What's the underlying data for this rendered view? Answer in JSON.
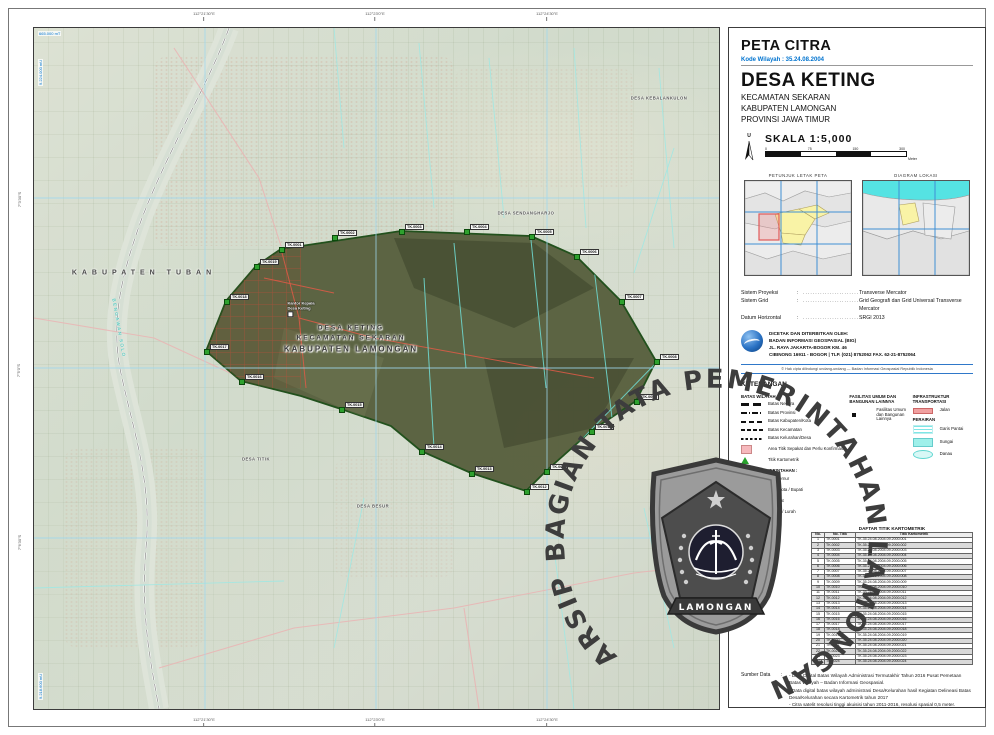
{
  "header": {
    "title": "PETA CITRA",
    "kode": "Kode Wilayah : 35.24.08.2004",
    "village": "DESA KETING",
    "admin_lines": [
      "KECAMATAN SEKARAN",
      "KABUPATEN LAMONGAN",
      "PROVINSI JAWA TIMUR"
    ],
    "north_label": "U",
    "skala_label": "SKALA  1:5,000",
    "scalebar_ticks": [
      "0",
      "75",
      "150",
      "300"
    ],
    "scalebar_unit": "Meter"
  },
  "insets": {
    "left_caption": "PETUNJUK LETAK PETA",
    "right_caption": "DIAGRAM LOKASI"
  },
  "projection": {
    "rows": [
      {
        "label": "Sistem Proyeksi",
        "value": "Transverse Mercator"
      },
      {
        "label": "Sistem Grid",
        "value": "Grid Geografi dan Grid Universal Transverse Mercator"
      },
      {
        "label": "Datum Horizontal",
        "value": "SRGI 2013"
      }
    ]
  },
  "publisher": {
    "lines": [
      "DICETAK DAN DITERBITKAN OLEH:",
      "BADAN INFORMASI GEOSPASIAL (BIG)",
      "JL. RAYA JAKARTA-BOGOR KM. 46",
      "CIBINONG 16911 - BOGOR | TLP. (021) 8752062 FAX. 62-21-8752064"
    ],
    "copyright": "© Hak cipta dilindungi undang-undang — Badan Informasi Geospasial Republik Indonesia"
  },
  "legend": {
    "title": "KETERANGAN",
    "batas_title": "BATAS WILAYAH :",
    "batas_items": [
      {
        "label": "Batas Negara",
        "style": "sw-negara"
      },
      {
        "label": "Batas Provinsi",
        "style": "sw-provinsi"
      },
      {
        "label": "Batas Kabupaten/Kota",
        "style": "sw-kabkota"
      },
      {
        "label": "Batas Kecamatan",
        "style": "sw-kecamatan"
      },
      {
        "label": "Batas Kelurahan/Desa",
        "style": "sw-desa"
      },
      {
        "label": "Area Titik Sepakat dan Perlu Konfirmasi",
        "style": "sw-area"
      },
      {
        "label": "Titik Kartometrik",
        "style": "sw-titik"
      }
    ],
    "fasum_title": "FASILITAS UMUM DAN BANGUNAN LAINNYA",
    "fasum_items": [
      {
        "label": "Fasilitas Umum dan Bangunan Lainnya",
        "style": "sw-fasum"
      }
    ],
    "infra_title": "INFRASTRUKTUR TRANSPORTASI",
    "infra_items": [
      {
        "label": "Jalan",
        "style": "sw-jalan"
      }
    ],
    "perairan_title": "PERAIRAN",
    "perairan_items": [
      {
        "label": "Garis Pantai",
        "style": "sw-pantai"
      },
      {
        "label": "Sungai",
        "style": "sw-sungai"
      },
      {
        "label": "Danau",
        "style": "sw-danau"
      }
    ],
    "kantor_title": "KANTOR PEMERINTAHAN :",
    "kantor_items": [
      {
        "label": "Gubernur",
        "cls": "one"
      },
      {
        "label": "Walikota / Bupati",
        "cls": "two"
      },
      {
        "label": "Camat",
        "cls": "one"
      },
      {
        "label": "Desa / Lurah",
        "cls": "two"
      }
    ]
  },
  "table": {
    "title": "DAFTAR TITIK KARTOMETRIK",
    "headers": [
      "No.",
      "No. Titik",
      "Titik Kartometrik"
    ],
    "rows": [
      [
        "1",
        "TK.0001",
        "TK.35.24.08.2004.09.2000.001"
      ],
      [
        "2",
        "TK.0002",
        "TK.35.24.08.2004.09.2000.002"
      ],
      [
        "3",
        "TK.0003",
        "TK.35.24.08.2004.09.2000.003"
      ],
      [
        "4",
        "TK.0004",
        "TK.35.24.08.2004.09.2000.004"
      ],
      [
        "5",
        "TK.0005",
        "TK.35.24.08.2004.09.2000.005"
      ],
      [
        "6",
        "TK.0006",
        "TK.35.24.08.2004.09.2000.006"
      ],
      [
        "7",
        "TK.0007",
        "TK.35.24.08.2004.09.2000.007"
      ],
      [
        "8",
        "TK.0008",
        "TK.35.24.08.2004.09.2000.008"
      ],
      [
        "9",
        "TK.0009",
        "TK.35.24.08.2004.09.2000.009"
      ],
      [
        "10",
        "TK.0010",
        "TK.35.24.08.2004.09.2000.010"
      ],
      [
        "11",
        "TK.0011",
        "TK.35.24.08.2004.09.2000.011"
      ],
      [
        "12",
        "TK.0012",
        "TK.35.24.08.2004.09.2000.012"
      ],
      [
        "13",
        "TK.0013",
        "TK.35.24.08.2004.09.2000.013"
      ],
      [
        "14",
        "TK.0014",
        "TK.35.24.08.2004.09.2000.014"
      ],
      [
        "15",
        "TK.0015",
        "TK.35.24.08.2004.09.2000.015"
      ],
      [
        "16",
        "TK.0016",
        "TK.35.24.08.2004.09.2000.016"
      ],
      [
        "17",
        "TK.0017",
        "TK.35.24.08.2004.09.2000.017"
      ],
      [
        "18",
        "TK.0018",
        "TK.35.24.08.2004.09.2000.018"
      ],
      [
        "19",
        "TK.0019",
        "TK.35.24.08.2004.09.2000.019"
      ],
      [
        "20",
        "TK.0020",
        "TK.35.24.08.2004.09.2000.020"
      ],
      [
        "21",
        "TK.0021",
        "TK.35.24.08.2004.09.2000.021"
      ],
      [
        "22",
        "TK.0022",
        "TK.35.24.08.2004.09.2000.022"
      ],
      [
        "23",
        "TK.0023",
        "TK.35.24.08.2004.09.2000.023"
      ],
      [
        "24",
        "TK.0024",
        "TK.35.24.08.2004.09.2000.024"
      ]
    ]
  },
  "sources": {
    "label": "Sumber Data",
    "colon": ":",
    "items": [
      "- Data Digital Batas Wilayah Administrasi Termutakhir Tahun 2016 Pusat Pemetaan Batas Wilayah – Badan Informasi Geospasial.",
      "- Data digital batas wilayah administrasi Desa/Kelurahan hasil Kegiatan Delineasi Batas Desa/Kelurahan secara Kartometrik tahun 2017",
      "- Citra satelit resolusi tinggi akuisisi tahun 2011-2016, resolusi spasial 0,5 meter.",
      "- Data digital Peta Rupabumi Indonesia skala 1 : 25.000 Pusat Pemetaan Rupabumi dan Toponim - Badan Informasi Geospasial, edisi launching tahun 2016",
      "- Hasil Digitasi Unsur Transportasi dan Hidrografi Tahun 2017"
    ],
    "riwayat_label": "Riwayat Peta",
    "riwayat_items": [
      "- Peta Citra ini dibuat menggunakan data batas wilayah administrasi desa / kelurahan hasil delineasi secara kartometrik tahun 2017, yang ditampilkan di atas citra satelit resolusi tinggi dengan resolusi spasial 0,5 m hasil akuisisi tahun 2011-2016."
    ]
  },
  "map": {
    "region_label": "KABUPATEN TUBAN",
    "village_label_lines": [
      "DESA KETING",
      "KECAMATAN SEKARAN",
      "KABUPATEN LAMONGAN"
    ],
    "office_label_lines": [
      "Kantor Kepala",
      "Desa Keting"
    ],
    "river_label": "BENGAWAN SOLO",
    "area_labels": [
      {
        "text": "DESA SENDANGHARJO",
        "x": 492,
        "y": 185
      },
      {
        "text": "DESA KEBALANKULON",
        "x": 625,
        "y": 70
      },
      {
        "text": "DESA TITIK",
        "x": 222,
        "y": 431
      },
      {
        "text": "DESA BESUR",
        "x": 339,
        "y": 478
      }
    ],
    "markers": [
      {
        "id": "TK.0001",
        "x": 247,
        "y": 221
      },
      {
        "id": "TK.0002",
        "x": 300,
        "y": 209
      },
      {
        "id": "TK.0003",
        "x": 367,
        "y": 203
      },
      {
        "id": "TK.0004",
        "x": 432,
        "y": 203
      },
      {
        "id": "TK.0005",
        "x": 497,
        "y": 208
      },
      {
        "id": "TK.0006",
        "x": 542,
        "y": 228
      },
      {
        "id": "TK.0007",
        "x": 587,
        "y": 273
      },
      {
        "id": "TK.0008",
        "x": 622,
        "y": 333
      },
      {
        "id": "TK.0009",
        "x": 602,
        "y": 373
      },
      {
        "id": "TK.0010",
        "x": 557,
        "y": 403
      },
      {
        "id": "TK.0011",
        "x": 512,
        "y": 443
      },
      {
        "id": "TK.0012",
        "x": 492,
        "y": 463
      },
      {
        "id": "TK.0013",
        "x": 437,
        "y": 445
      },
      {
        "id": "TK.0014",
        "x": 387,
        "y": 423
      },
      {
        "id": "TK.0015",
        "x": 307,
        "y": 381
      },
      {
        "id": "TK.0016",
        "x": 207,
        "y": 353
      },
      {
        "id": "TK.0017",
        "x": 172,
        "y": 323
      },
      {
        "id": "TK.0018",
        "x": 192,
        "y": 273
      },
      {
        "id": "TK.0019",
        "x": 222,
        "y": 238
      }
    ],
    "corner_labels": [
      {
        "text": "665.000 mT",
        "x": 4,
        "y": 3,
        "cls": ""
      },
      {
        "text": "9.224.000 mU",
        "x": 4,
        "y": 58,
        "cls": "vert"
      },
      {
        "text": "9.218.600 mU",
        "x": 4,
        "y": 672,
        "cls": "vert"
      }
    ],
    "ticks_top": [
      {
        "text": "112°21'30\"E",
        "x": 204,
        "y": 11
      },
      {
        "text": "112°23'0\"E",
        "x": 375,
        "y": 11
      },
      {
        "text": "112°24'30\"E",
        "x": 547,
        "y": 11
      }
    ],
    "ticks_bottom": [
      {
        "text": "112°21'30\"E",
        "x": 204,
        "y": 717
      },
      {
        "text": "112°23'0\"E",
        "x": 375,
        "y": 717
      },
      {
        "text": "112°24'30\"E",
        "x": 547,
        "y": 717
      }
    ],
    "ticks_left": [
      {
        "text": "7°3'30\"S",
        "x": 12,
        "y": 197
      },
      {
        "text": "7°5'0\"S",
        "x": 12,
        "y": 368
      },
      {
        "text": "7°6'30\"S",
        "x": 12,
        "y": 540
      }
    ]
  },
  "watermark": {
    "arc_text": "ARSIP BAGIAN TATA PEMERINTAHAN LAMONGAN",
    "crest_banner": "LAMONGAN"
  }
}
